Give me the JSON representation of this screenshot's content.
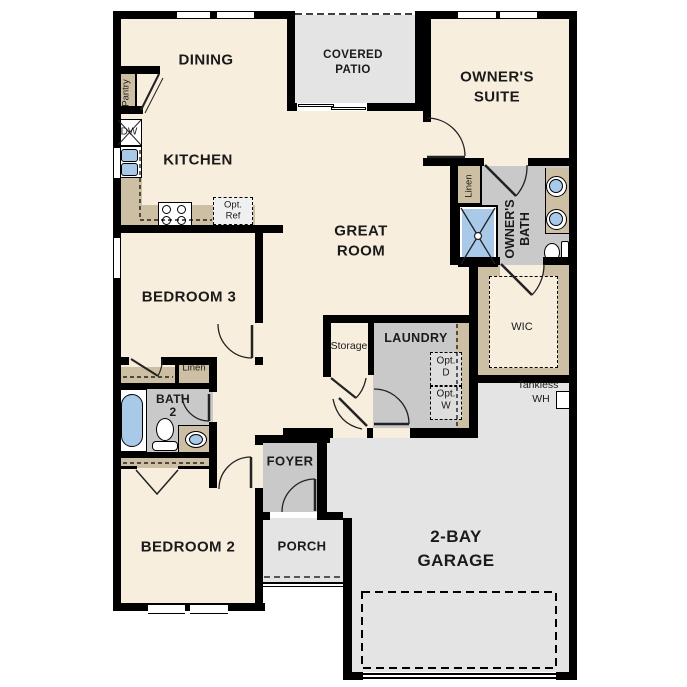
{
  "colors": {
    "floor": "#f7eedd",
    "room_gray": "#c9c9c9",
    "outdoor_gray": "#e4e4e4",
    "counter_tan": "#cdbfa3",
    "fixture_blue": "#a9c9e9",
    "wall": "#000000",
    "text": "#1a1a1a"
  },
  "rooms": {
    "dining": "DINING",
    "covered_patio_1": "COVERED",
    "covered_patio_2": "PATIO",
    "owners_suite_1": "OWNER'S",
    "owners_suite_2": "SUITE",
    "kitchen": "KITCHEN",
    "great_room_1": "GREAT",
    "great_room_2": "ROOM",
    "owners_bath_1": "OWNER'S",
    "owners_bath_2": "BATH",
    "bedroom3": "BEDROOM 3",
    "wic": "WIC",
    "storage": "Storage",
    "laundry": "LAUNDRY",
    "bath2_1": "BATH",
    "bath2_2": "2",
    "foyer": "FOYER",
    "porch": "PORCH",
    "bedroom2": "BEDROOM 2",
    "garage_1": "2-BAY",
    "garage_2": "GARAGE"
  },
  "small": {
    "pantry": "Pantry",
    "dw": "DW",
    "opt_ref_1": "Opt.",
    "opt_ref_2": "Ref",
    "linen_owner": "Linen",
    "linen_hall": "Linen",
    "opt_d_1": "Opt.",
    "opt_d_2": "D",
    "opt_w_1": "Opt.",
    "opt_w_2": "W",
    "tankless_1": "Tankless",
    "tankless_2": "WH"
  }
}
